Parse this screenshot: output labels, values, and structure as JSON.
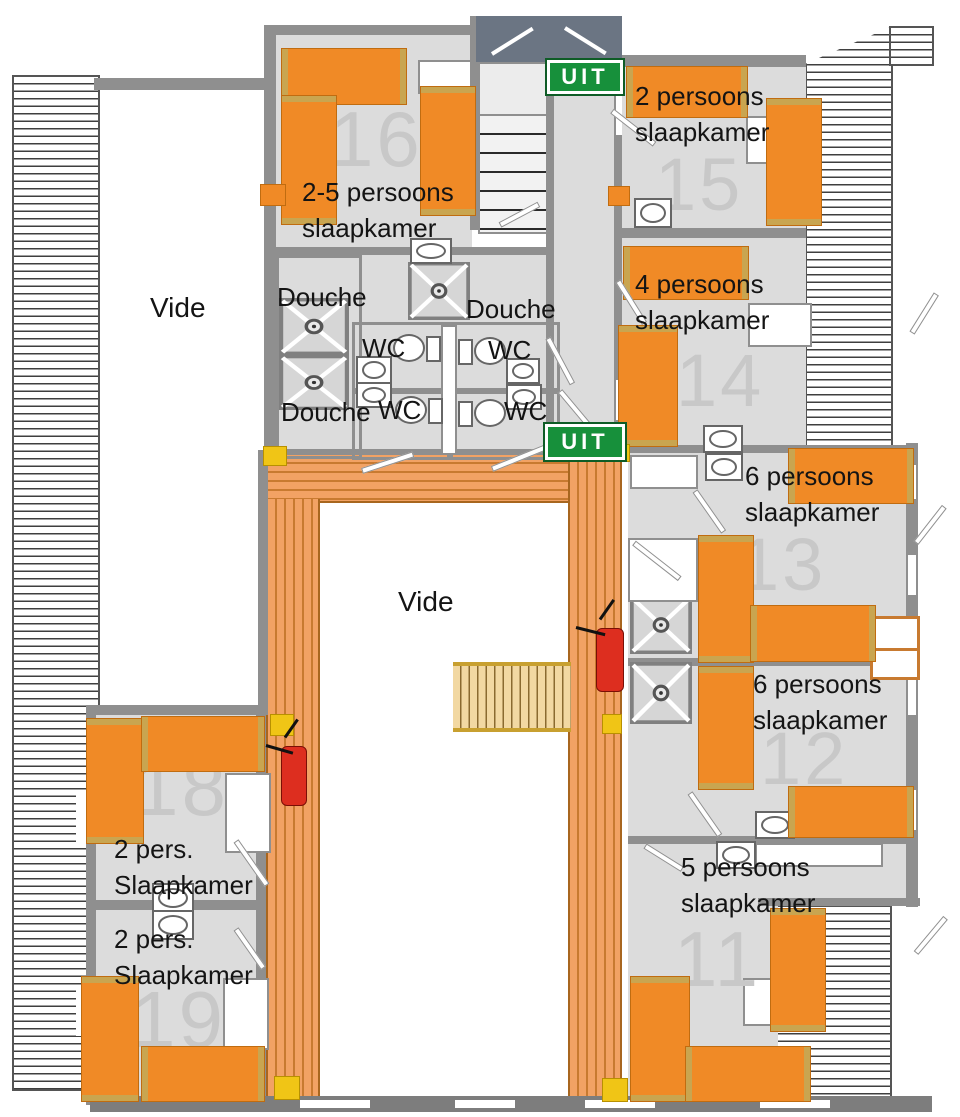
{
  "exit_signs": {
    "uit1": "UIT",
    "uit2": "UIT"
  },
  "vides": {
    "left": "Vide",
    "center": "Vide"
  },
  "rooms": {
    "r16": {
      "number": "16",
      "line1": "2-5 persoons",
      "line2": "slaapkamer"
    },
    "r15": {
      "number": "15",
      "line1": "2 persoons",
      "line2": "slaapkamer"
    },
    "r14": {
      "number": "14",
      "line1": "4 persoons",
      "line2": "slaapkamer"
    },
    "r13": {
      "number": "13",
      "line1": "6 persoons",
      "line2": "slaapkamer"
    },
    "r12": {
      "number": "12",
      "line1": "6 persoons",
      "line2": "slaapkamer"
    },
    "r11": {
      "number": "11",
      "line1": "5 persoons",
      "line2": "slaapkamer"
    },
    "r18": {
      "number": "18",
      "line1": "2 pers.",
      "line2": "Slaapkamer"
    },
    "r19": {
      "number": "19",
      "line1": "2 pers.",
      "line2": "Slaapkamer"
    }
  },
  "bathroom": {
    "douche1": "Douche",
    "douche2": "Douche",
    "douche3": "Douche",
    "wc1": "WC",
    "wc2": "WC",
    "wc3": "WC",
    "wc4": "WC"
  },
  "colors": {
    "bed_orange": "#F08A26",
    "corridor_orange": "#F2A264",
    "exit_green": "#17903B",
    "floor_gray": "#DCDCDC",
    "wall_gray": "#8F8F8F",
    "extinguisher_red": "#DD2E1F",
    "marker_yellow": "#F0C516",
    "room_number_gray": "#C8C8C8"
  }
}
